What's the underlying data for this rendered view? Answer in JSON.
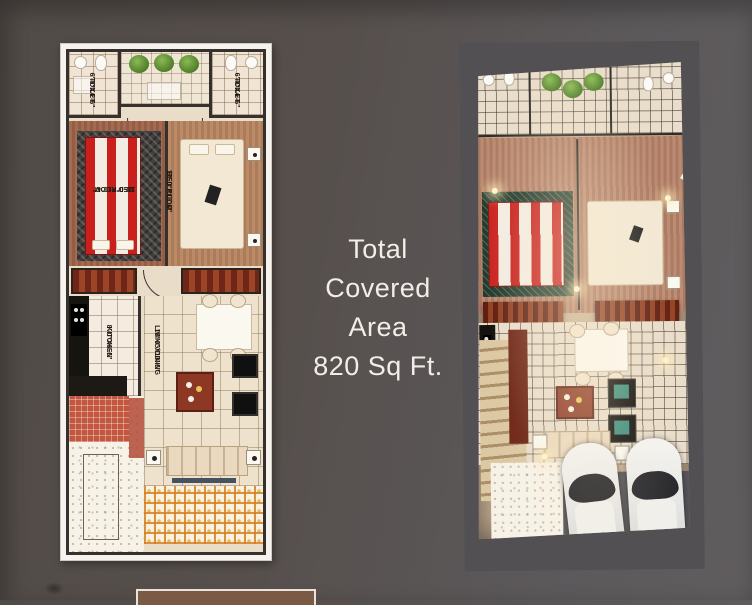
{
  "page": {
    "background_left": "#544e4a",
    "background_right": "#5f5c5e",
    "description": "Real-estate floor plan sheet: 2D plan (left), 3D rendered plan (right), covered-area caption in centre"
  },
  "center_text": {
    "lines": [
      "Total",
      "Covered",
      "Area",
      "820 Sq Ft."
    ]
  },
  "plan2d": {
    "rooms": {
      "toilet_left": {
        "name": "TOILET",
        "dims": "6'-0\"X4'-6\""
      },
      "toilet_right": {
        "name": "TOILET",
        "dims": "6'-0\"X4'-6\""
      },
      "bedroom_left": {
        "name": "BED ROOM",
        "dims": "12'-0\"X10'-0\""
      },
      "bedroom_right": {
        "name": "BED ROOM",
        "dims": "12'-0\"X10'-0\""
      },
      "kitchen": {
        "name": "KITCHEN",
        "dims": "8'-0\"X6'-6\""
      },
      "living_dining": {
        "name": "LIVING/DINING",
        "dims": "18'-0\"X13'-6\""
      }
    }
  },
  "colors": {
    "caption_text": "#f1eee8",
    "bed_red": "#c9201d",
    "wardrobe_wood": "#7c2d1b",
    "lattice_orange": "#d48023",
    "plan_wall": "#37312d"
  }
}
